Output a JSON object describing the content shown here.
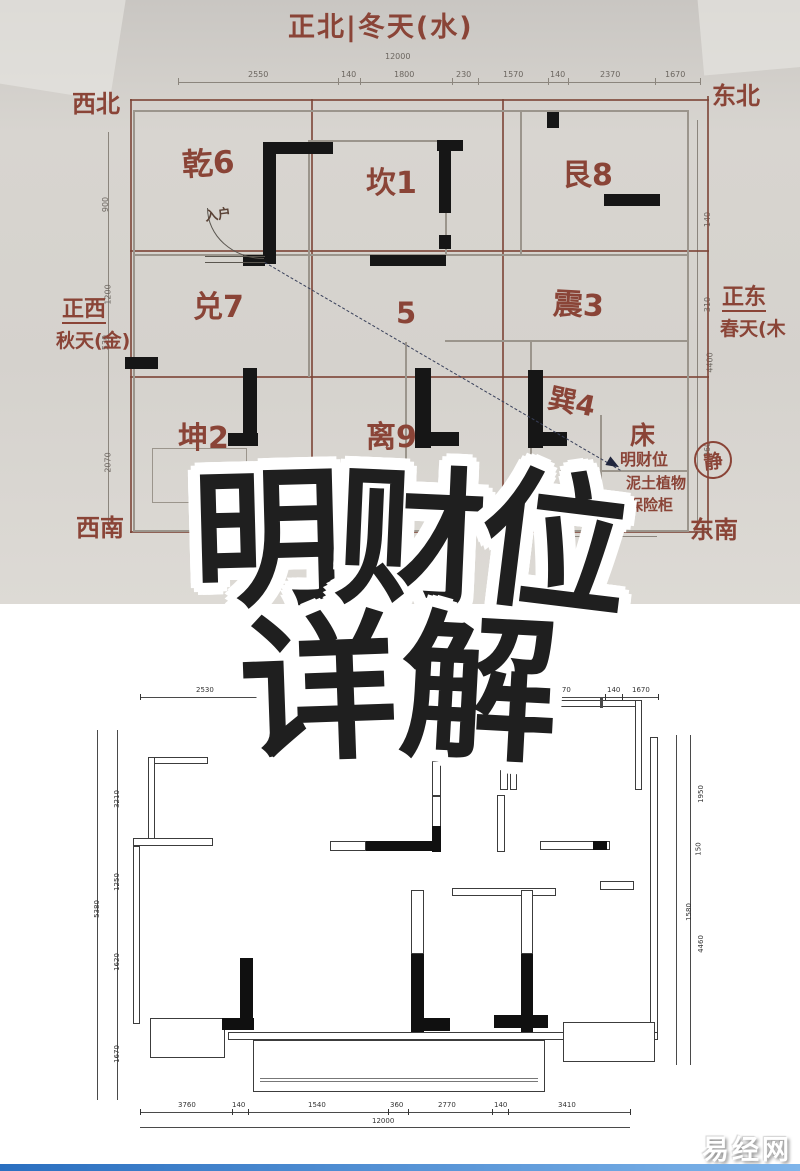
{
  "watermark": "易经网",
  "overlay": {
    "c1": "明",
    "c2": "财",
    "c3": "位",
    "c4": "详",
    "c5": "解"
  },
  "top_plan": {
    "title": "正北|冬天(水)",
    "corners": {
      "nw": "西北",
      "ne": "东北",
      "sw": "西南",
      "se": "东南"
    },
    "west": {
      "line1": "正西",
      "line2": "秋天(金)"
    },
    "east": {
      "line1": "正东",
      "line2": "春天(木"
    },
    "bagua": [
      "乾6",
      "坎1",
      "艮8",
      "兑7",
      "5",
      "震3",
      "坤2",
      "离9",
      "巽4"
    ],
    "entrance": "入户",
    "bed": "床",
    "note": {
      "line1": "明财位",
      "line2": "泥土植物",
      "line3": "保险柜"
    },
    "seal": "静",
    "dims": {
      "total_top": "12000",
      "top": [
        "2550",
        "140",
        "1800",
        "230",
        "1570",
        "140",
        "2370",
        "1670"
      ],
      "left": [
        "900",
        "1200",
        "530",
        "2070"
      ],
      "right": [
        "140",
        "310",
        "4400",
        "260"
      ],
      "misc": "2500"
    }
  },
  "bottom_plan": {
    "dims": {
      "top": [
        "2530",
        "2570",
        "140",
        "1670"
      ],
      "bottom": [
        "3760",
        "140",
        "1540",
        "360",
        "2770",
        "140",
        "3410"
      ],
      "bottom_total": "12000",
      "left": [
        "3210",
        "1250",
        "1620",
        "1670"
      ],
      "left_outer": "5380",
      "right": [
        "1950",
        "150",
        "4460"
      ],
      "right_inner": "1580"
    }
  }
}
